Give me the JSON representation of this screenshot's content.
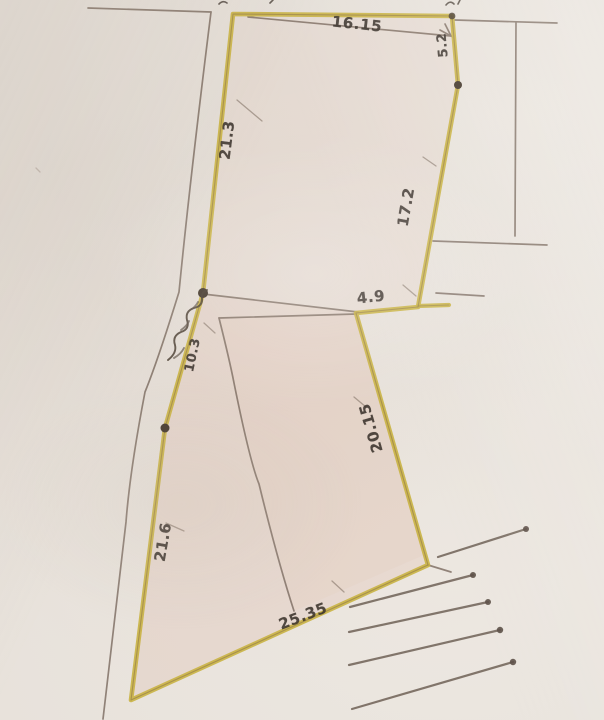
{
  "sketch": {
    "measurements": {
      "top_edge": "16.15",
      "upper_right_edge": "5.2",
      "right_edge": "17.2",
      "upper_left_edge": "21.3",
      "road_segment": "10.3",
      "junction_segment": "4.9",
      "lower_right_edge": "20.15",
      "lower_left_edge": "21.6",
      "bottom_edge": "25.35"
    },
    "icons": {
      "road_script": "cursive-handwriting-squiggle",
      "survey_point": "filled-pen-dot",
      "road_hatch": "parallel-lines-with-end-dots"
    },
    "colors": {
      "paper": "#e6e0d9",
      "plot_outline_highlight": "#c9b343",
      "pencil_line": "#7d6d61",
      "ink_text": "#3b332c"
    }
  }
}
